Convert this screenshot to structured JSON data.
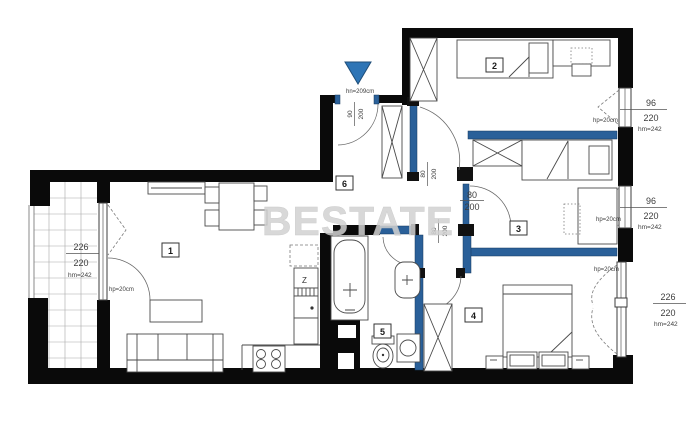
{
  "watermark": "BESTATE",
  "colors": {
    "wall": "#0a0a0a",
    "partition_wall": "#2a6099",
    "entry_marker": "#2e75b6",
    "dimension_text": "#3d3d3d",
    "watermark_gray": "#d2d2d2"
  },
  "rooms": {
    "living": "1",
    "bedroom_a": "2",
    "bedroom_b": "3",
    "bedroom_c": "4",
    "bathroom": "5",
    "hall": "6"
  },
  "entrance": {
    "lintel": "hn=209cm",
    "door": {
      "w": "90",
      "h": "200"
    }
  },
  "doors": {
    "hall_bedroom_a": {
      "w": "80",
      "h": "200"
    },
    "bedroom_b": {
      "w": "80",
      "h": "200"
    },
    "bathroom": {
      "w": "80",
      "h": "200"
    }
  },
  "windows": {
    "left": {
      "w": "226",
      "h": "220",
      "lintel": "hm=242",
      "sill": "hp=20cm"
    },
    "right_top": {
      "w": "96",
      "h": "220",
      "lintel": "hm=242",
      "sill": "hp=20cm"
    },
    "right_mid": {
      "w": "96",
      "h": "220",
      "lintel": "hm=242",
      "sill": "hp=20cm"
    },
    "right_bottom": {
      "w": "226",
      "h": "220",
      "lintel": "hm=242",
      "sill": "hp=20cm"
    }
  },
  "appliances": {
    "fridge_symbol": "Z"
  }
}
